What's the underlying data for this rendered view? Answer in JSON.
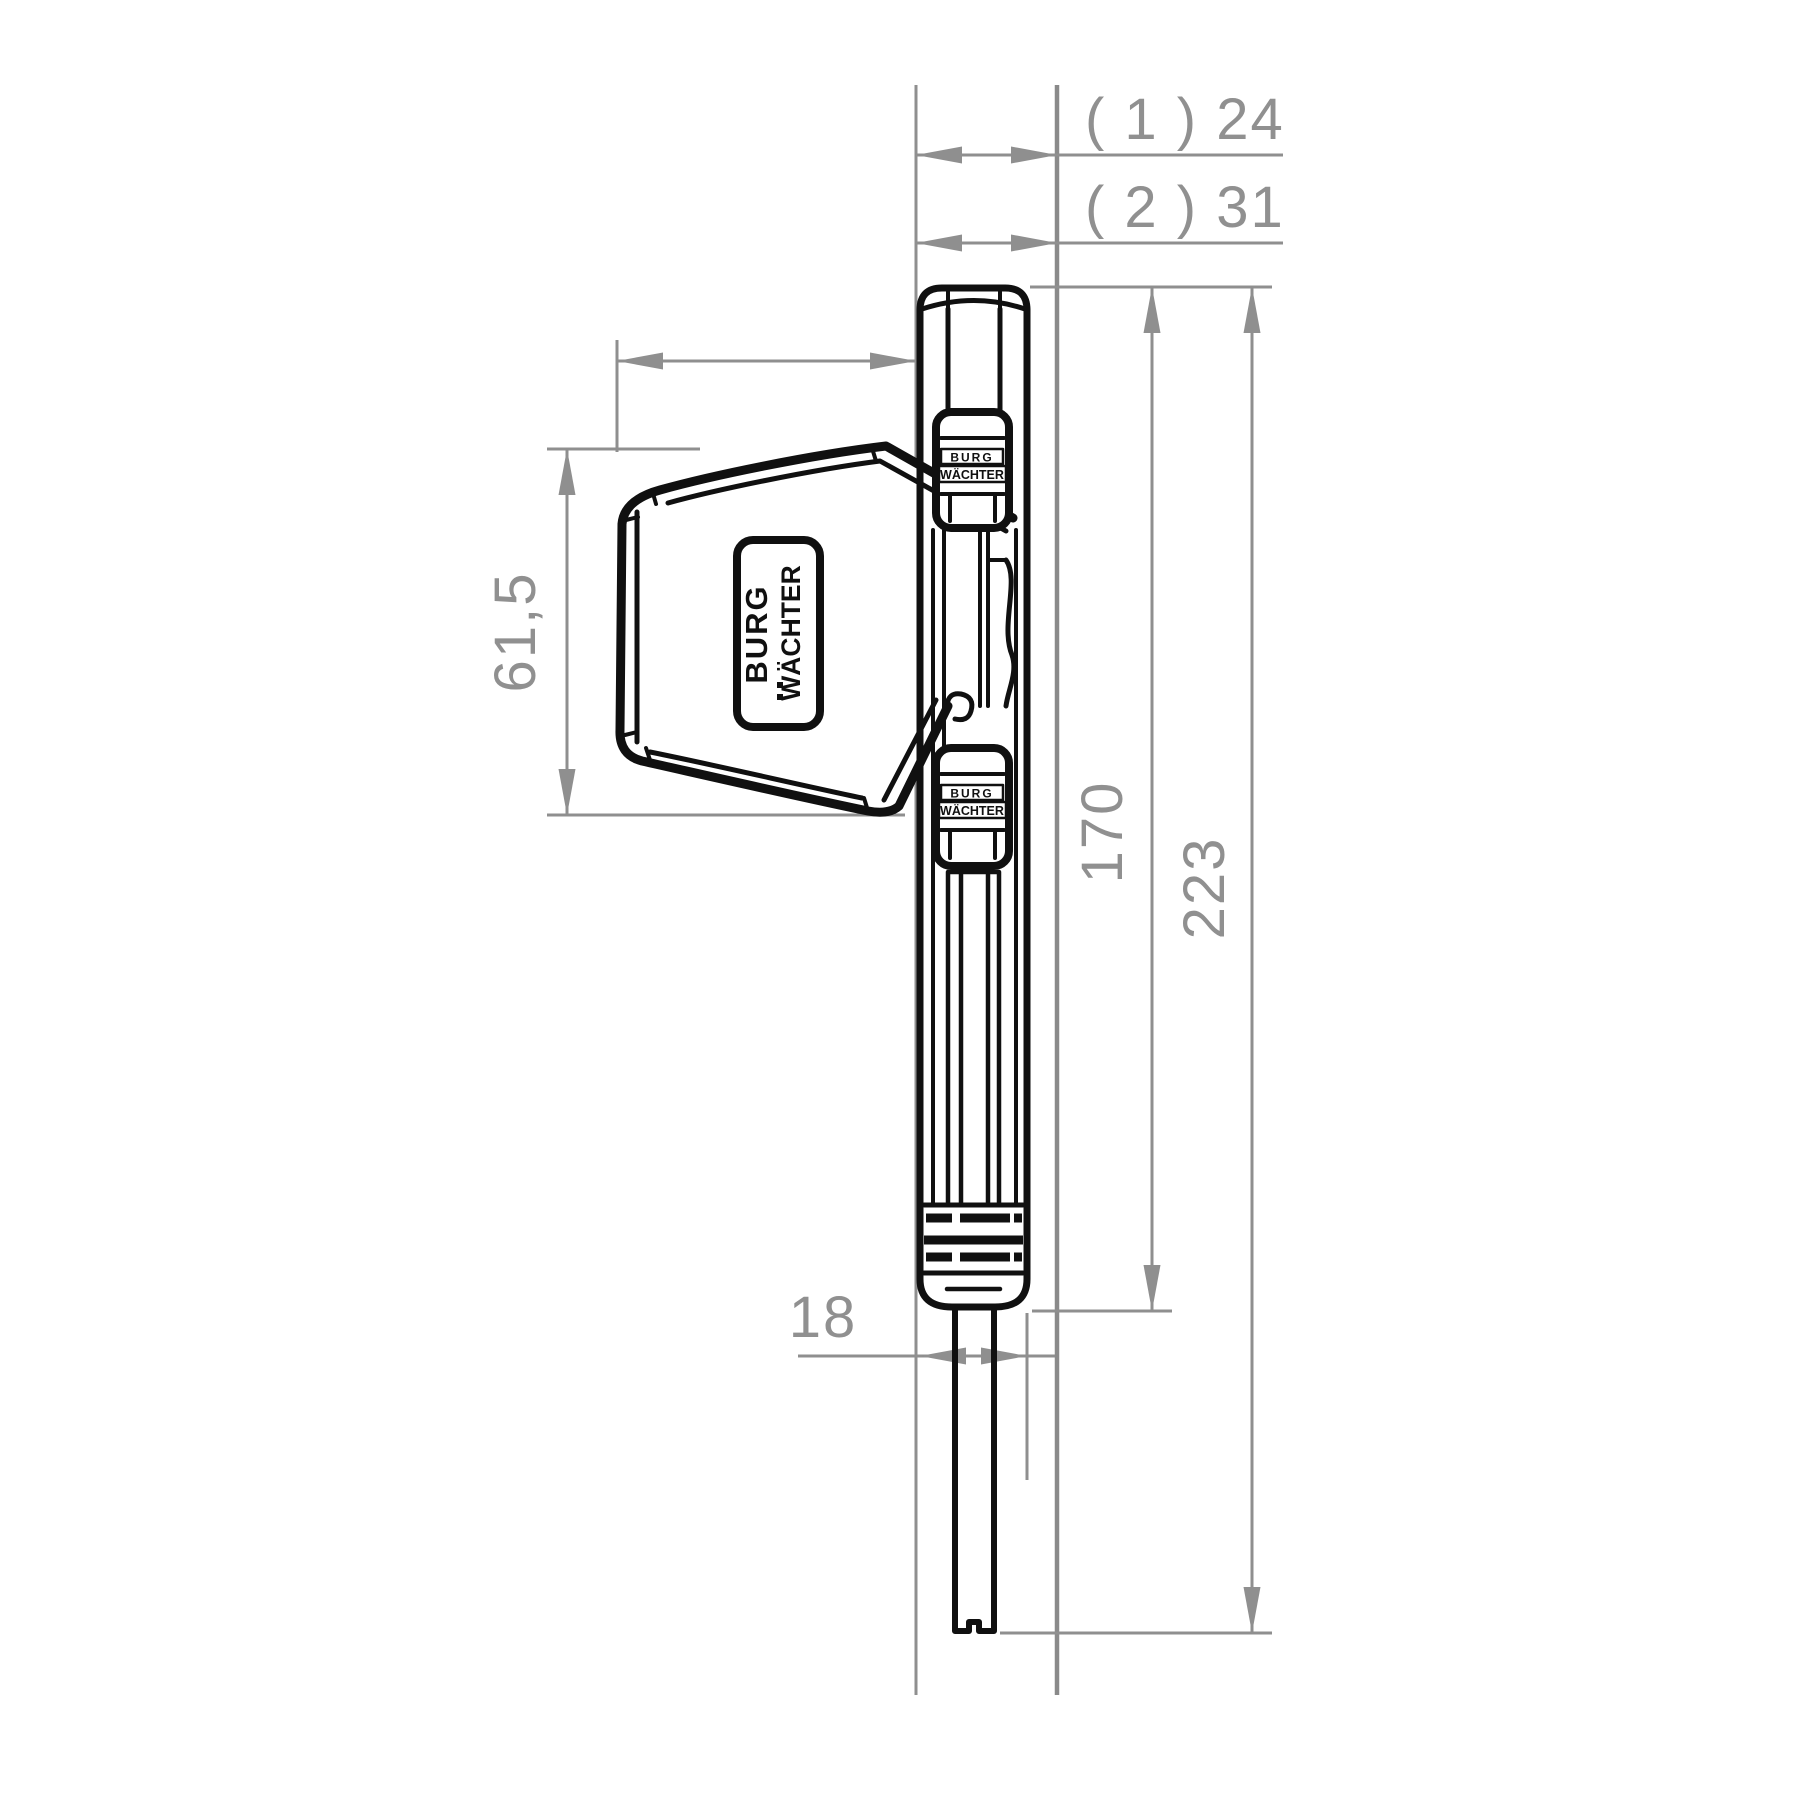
{
  "drawing": {
    "title": "window-lock-side-view-dimension-drawing",
    "brand": {
      "line1": "BURG",
      "line2": "WÄCHTER"
    },
    "dimensions": {
      "offset_variant_1": "( 1 ) 24",
      "offset_variant_2": "( 2 ) 31",
      "body_height": "170",
      "total_height": "223",
      "head_height": "61,5",
      "body_width": "18"
    },
    "colors": {
      "dimension_gray": "#8f8f8f",
      "ink_black": "#101010",
      "background": "#ffffff"
    }
  }
}
